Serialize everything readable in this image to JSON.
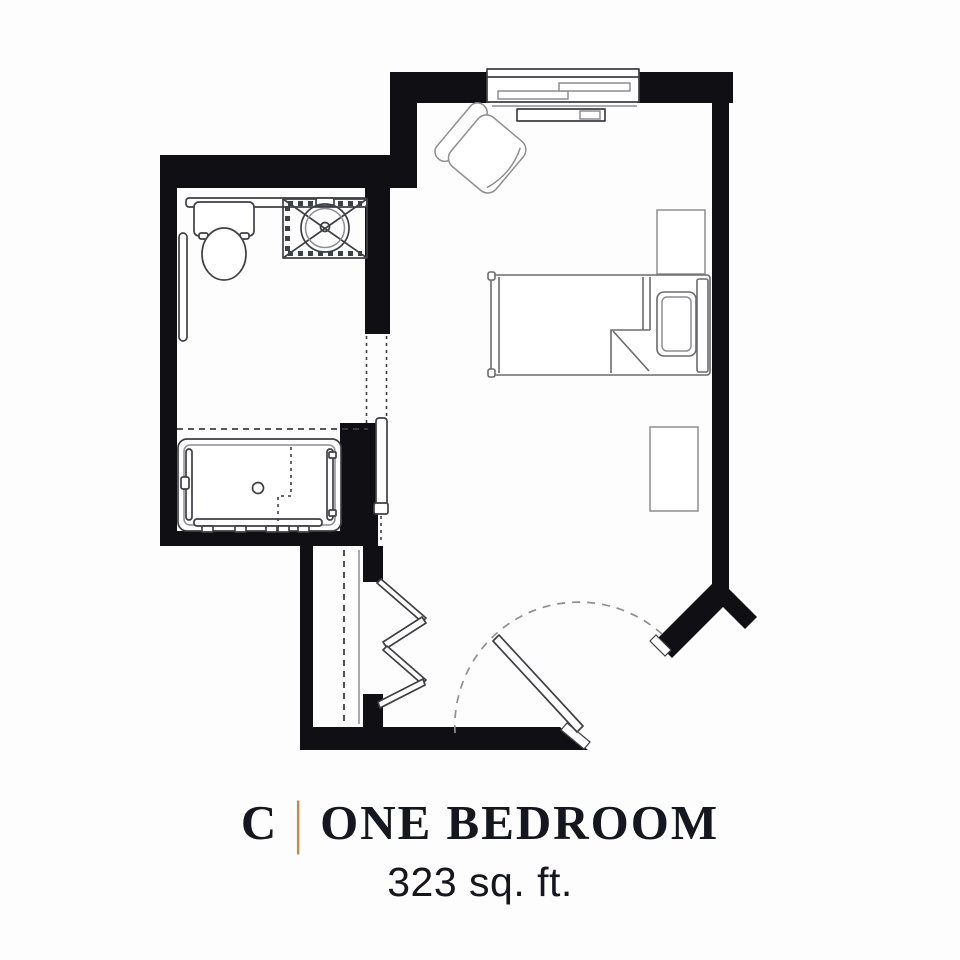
{
  "caption": {
    "unit_letter": "C",
    "separator": "|",
    "unit_type": "ONE BEDROOM",
    "area": "323 sq. ft."
  },
  "colors": {
    "bg": "#fdfdfd",
    "wall": "#101014",
    "line": "#3f3f46",
    "line-mid": "#6b6b70",
    "line-light": "#8e8e93",
    "dash": "#8f8f94",
    "accent": "#C0903F",
    "ink": "#16161e"
  }
}
